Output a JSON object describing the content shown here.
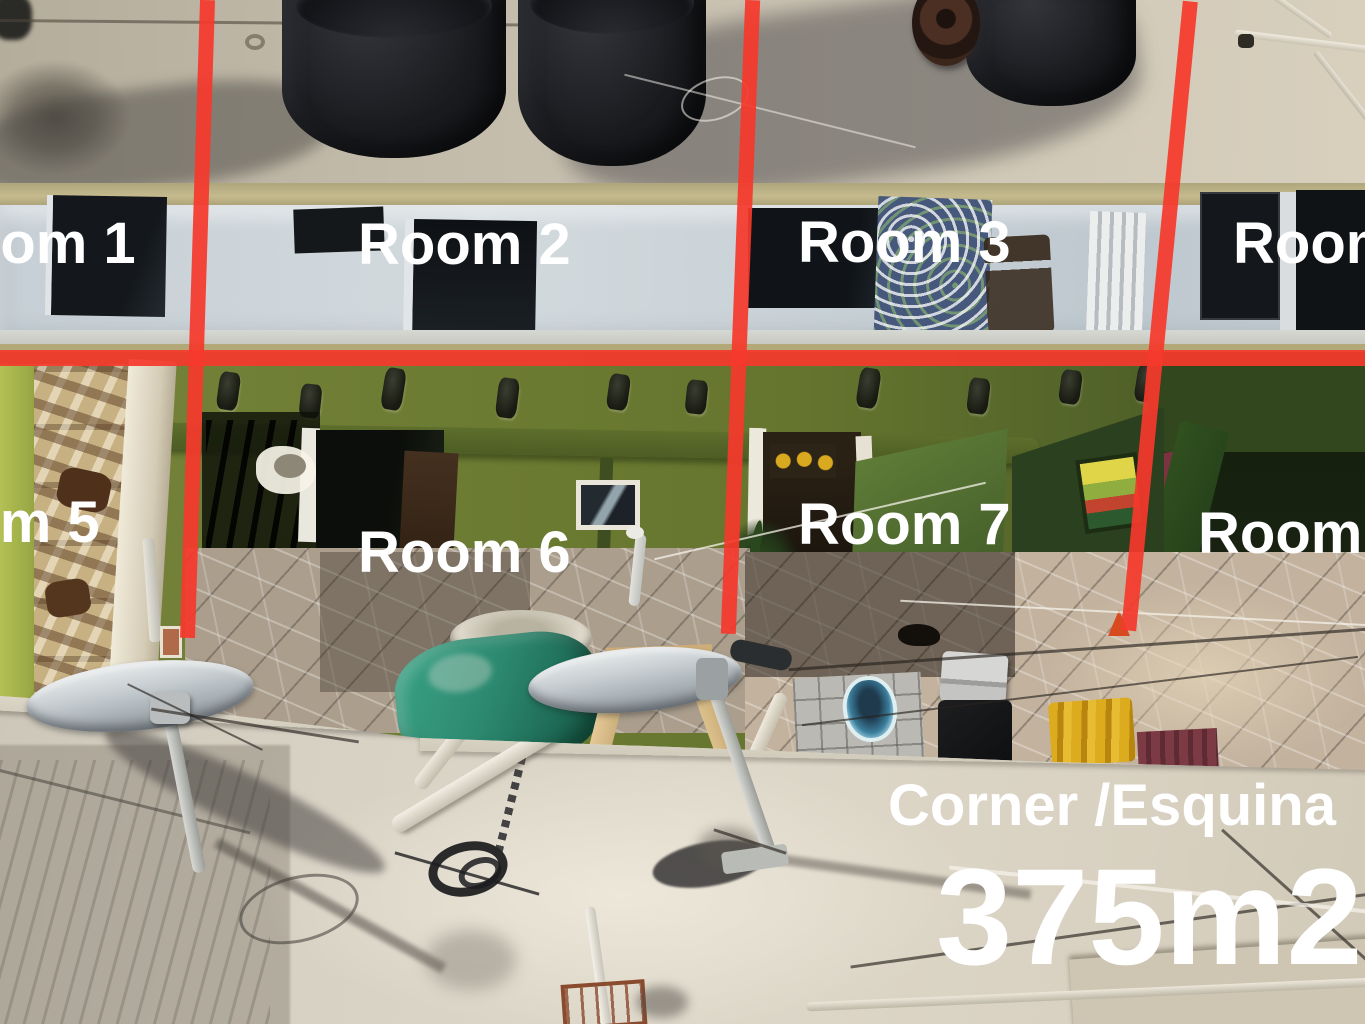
{
  "scene": {
    "type": "annotated-aerial-photo",
    "description": "Drone photo of a corner rental property: rooftop with black water tanks, white room block, green courtyard, satellite dishes on front roof; red lines divide the units"
  },
  "annotations": {
    "rooms": [
      {
        "id": 1,
        "label": "Room 1"
      },
      {
        "id": 2,
        "label": "Room 2"
      },
      {
        "id": 3,
        "label": "Room 3"
      },
      {
        "id": 4,
        "label": "Room 4"
      },
      {
        "id": 5,
        "label": "Room 5"
      },
      {
        "id": 6,
        "label": "Room 6"
      },
      {
        "id": 7,
        "label": "Room 7"
      },
      {
        "id": 8,
        "label": "Room 8"
      }
    ],
    "corner_label": "Corner /Esquina",
    "area_label": "375m2"
  },
  "colors": {
    "divider_red": "#f5392c",
    "label_text": "#ffffff",
    "courtyard_green": "#68772f",
    "dark_green_shade": "#32471d",
    "roof_concrete": "#d7d1c4",
    "upper_wall": "#c9d2d8",
    "tank_black": "#17181a",
    "wheelbarrow_teal": "#2d8a70",
    "stairs_tan": "#c7b183"
  }
}
